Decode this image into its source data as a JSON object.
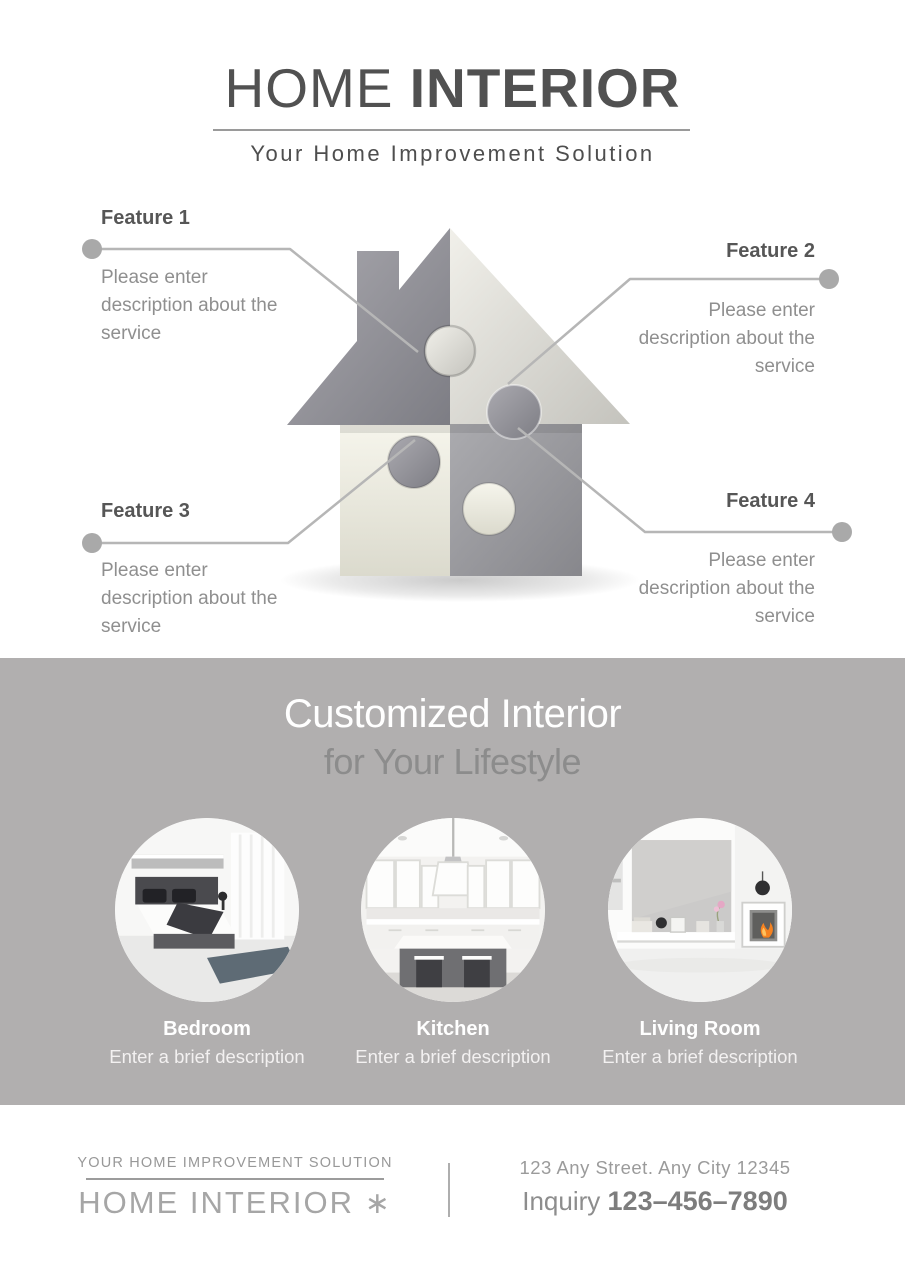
{
  "header": {
    "brand_light": "HOME",
    "brand_bold": "INTERIOR",
    "tagline": "Your Home Improvement Solution"
  },
  "features": [
    {
      "title": "Feature 1",
      "description": "Please enter description about the service"
    },
    {
      "title": "Feature 2",
      "description": "Please enter description about the service"
    },
    {
      "title": "Feature 3",
      "description": "Please enter description about the service"
    },
    {
      "title": "Feature 4",
      "description": "Please enter description about the service"
    }
  ],
  "showcase": {
    "heading_line1": "Customized Interior",
    "heading_line2": "for Your Lifestyle",
    "rooms": [
      {
        "name": "Bedroom",
        "description": "Enter a brief description"
      },
      {
        "name": "Kitchen",
        "description": "Enter a brief description"
      },
      {
        "name": "Living Room",
        "description": "Enter a brief description"
      }
    ]
  },
  "footer": {
    "tagline": "YOUR HOME IMPROVEMENT SOLUTION",
    "brand": "HOME INTERIOR",
    "logo_mark": "∗",
    "address": "123 Any Street. Any City 12345",
    "inquiry_label": "Inquiry",
    "phone": "123–456–7890"
  },
  "colors": {
    "band_gray": "#b1afaf",
    "text_dark": "#515151",
    "text_muted": "#8f8f8f",
    "connector_gray": "#b6b6b6",
    "flame_orange": "#f58220"
  }
}
